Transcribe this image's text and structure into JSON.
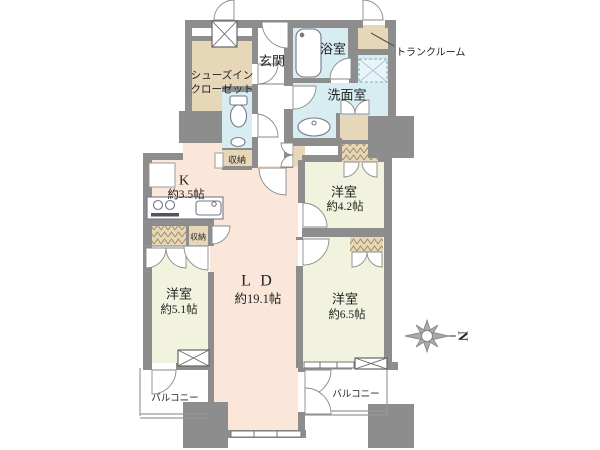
{
  "palette": {
    "wall": "#8d8d8d",
    "room_ld": "#fae7da",
    "room_western": "#f2f3de",
    "room_wet": "#d8edf2",
    "closet": "#e7d7b9",
    "line": "#888888",
    "text": "#222222"
  },
  "labels": {
    "shoes_closet_line1": "シューズイン",
    "shoes_closet_line2": "クローゼット",
    "entrance": "玄関",
    "bathroom": "浴室",
    "trunk_room": "トランクルーム",
    "washroom": "洗面室",
    "storage_hall": "収納",
    "storage_kitchen": "収納",
    "kitchen": "K",
    "kitchen_size": "約3.5帖",
    "living_dining": "L D",
    "living_dining_size": "約19.1帖",
    "western_room_42": "洋室",
    "western_room_42_size": "約4.2帖",
    "western_room_51": "洋室",
    "western_room_51_size": "約5.1帖",
    "western_room_65": "洋室",
    "western_room_65_size": "約6.5帖",
    "balcony_left": "バルコニー",
    "balcony_right": "バルコニー",
    "compass_north": "N"
  }
}
